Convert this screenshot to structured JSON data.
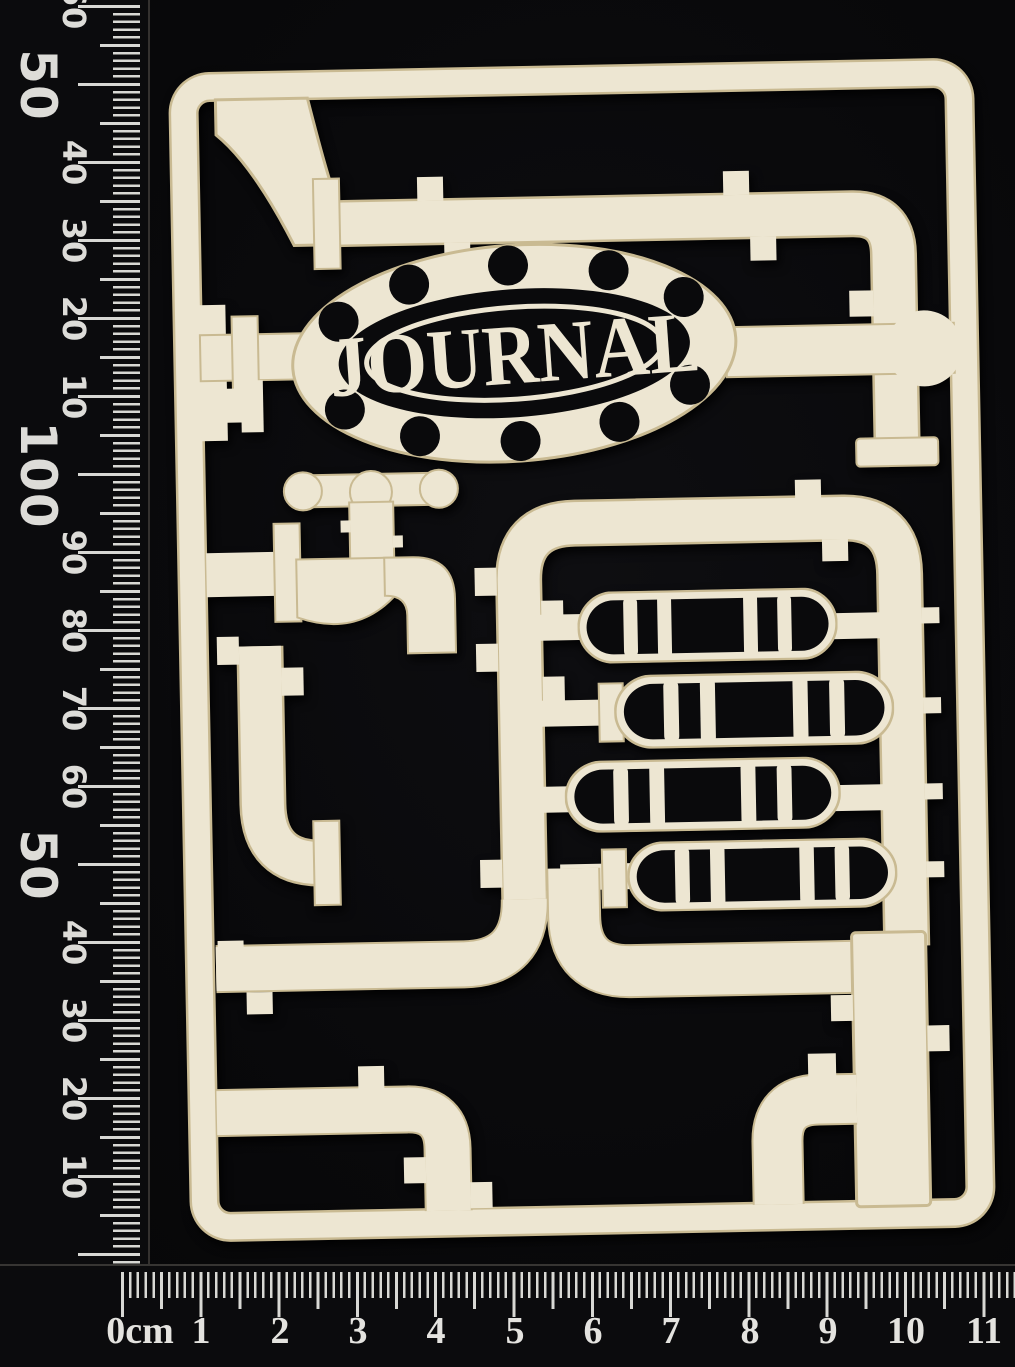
{
  "scene": {
    "type": "product-photo",
    "subject": "Laser-cut steampunk pipework journal chipboard frame on black card, photographed with metric rulers",
    "background_color": "#09090b",
    "chipboard_color": "#ece5d0",
    "scorch_edge_color": "#c7b астра88",
    "ruler_marking_color": "#d8d8d4"
  },
  "board": {
    "plaque_text": "JOURNAL",
    "plaque_rivet_count": 10,
    "tank_count": 4,
    "features": "pipes, flanged joints, tap with cross handle, riveted oval plaque, banded tanks"
  },
  "rulers": {
    "left": {
      "orientation": "vertical",
      "unit": "mm",
      "labels": [
        "60",
        "50",
        "40",
        "30",
        "20",
        "10",
        "100",
        "90",
        "80",
        "70",
        "60",
        "50",
        "40",
        "30",
        "20",
        "10"
      ]
    },
    "bottom": {
      "orientation": "horizontal",
      "unit": "cm",
      "labels": [
        "0cm",
        "1",
        "2",
        "3",
        "4",
        "5",
        "6",
        "7",
        "8",
        "9",
        "10",
        "11"
      ]
    }
  }
}
